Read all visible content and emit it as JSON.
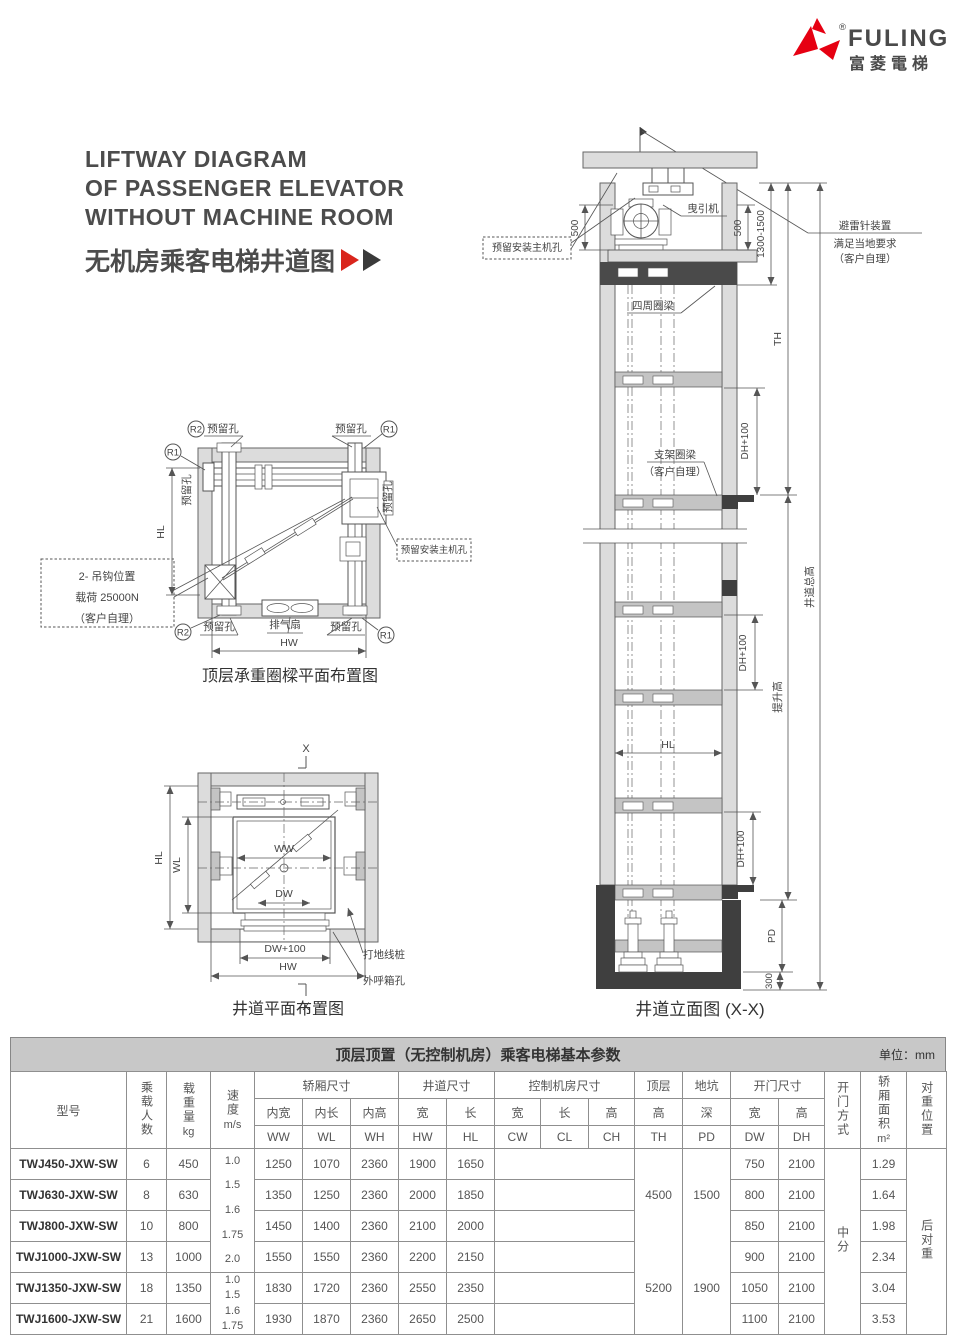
{
  "colors": {
    "brand_red": "#e60012",
    "arrow_red": "#d9251c",
    "ink": "#4c4c4c"
  },
  "logo": {
    "brand": "FULING",
    "brand_cn": "富菱電梯",
    "registered": "®"
  },
  "title": {
    "line1": "LIFTWAY DIAGRAM",
    "line2": "OF PASSENGER ELEVATOR",
    "line3": "WITHOUT MACHINE ROOM",
    "subtitle_cn": "无机房乘客电梯井道图"
  },
  "plan_top": {
    "caption": "顶层承重圈樑平面布置图",
    "r1": "R1",
    "r2": "R2",
    "hole": "预留孔",
    "hl": "HL",
    "hw": "HW",
    "fan": "排气扇",
    "hook1": "2- 吊钩位置",
    "hook2": "载荷 25000N",
    "hook3": "（客户自理）",
    "machine_hole": "预留安装主机孔"
  },
  "plan_bottom": {
    "caption": "井道平面布置图",
    "x": "X",
    "hl": "HL",
    "wl": "WL",
    "ww": "WW",
    "dw": "DW",
    "dw100": "DW+100",
    "hw": "HW",
    "stake": "打地线桩",
    "callbox": "外呼箱孔"
  },
  "elevation": {
    "caption": "井道立面图 (X-X)",
    "traction": "曳引机",
    "machine_hole": "预留安装主机孔",
    "d500": "500",
    "d1300": "1300-1500",
    "lightning1": "避雷针装置",
    "lightning2": "满足当地要求",
    "lightning3": "（客户自理）",
    "ring": "四周圈梁",
    "support1": "支架圈梁",
    "support2": "（客户自理）",
    "th": "TH",
    "total": "井道总高",
    "lift": "提升高",
    "dh100": "DH+100",
    "hl": "HL",
    "pd": "PD",
    "d300": "300"
  },
  "table": {
    "title": "顶层顶置（无控制机房）乘客电梯基本参数",
    "unit": "单位：mm",
    "h": {
      "model": "型号",
      "persons": "乘载人数",
      "load": "载重量",
      "load_unit": "kg",
      "speed": "速度",
      "speed_unit": "m/s",
      "car": "轿厢尺寸",
      "shaft": "井道尺寸",
      "ctrl": "控制机房尺寸",
      "top": "顶层",
      "pit": "地坑",
      "door": "开门尺寸",
      "iw": "内宽",
      "il": "内长",
      "ih": "内高",
      "w": "宽",
      "l": "长",
      "h2": "高",
      "deep": "深",
      "ww": "WW",
      "wl": "WL",
      "wh": "WH",
      "hw": "HW",
      "hl": "HL",
      "cw": "CW",
      "cl": "CL",
      "ch": "CH",
      "th": "TH",
      "pd": "PD",
      "dw": "DW",
      "dh": "DH",
      "door_mode": "开门方式",
      "area": "轿厢面积",
      "area_unit": "m²",
      "cwp": "对重位置"
    },
    "speed_g1": [
      "1.0",
      "1.5",
      "1.6",
      "1.75",
      "2.0"
    ],
    "speed_g2": [
      "1.0",
      "1.5",
      "1.6",
      "1.75"
    ],
    "th_vals": [
      "4500",
      "5200"
    ],
    "pd_vals": [
      "1500",
      "1900"
    ],
    "door_mode_val": "中分",
    "cwp_val": "后对重",
    "rows": [
      {
        "model": "TWJ450-JXW-SW",
        "p": "6",
        "load": "450",
        "ww": "1250",
        "wl": "1070",
        "wh": "2360",
        "hw": "1900",
        "hl": "1650",
        "dw": "750",
        "dh": "2100",
        "area": "1.29"
      },
      {
        "model": "TWJ630-JXW-SW",
        "p": "8",
        "load": "630",
        "ww": "1350",
        "wl": "1250",
        "wh": "2360",
        "hw": "2000",
        "hl": "1850",
        "dw": "800",
        "dh": "2100",
        "area": "1.64"
      },
      {
        "model": "TWJ800-JXW-SW",
        "p": "10",
        "load": "800",
        "ww": "1450",
        "wl": "1400",
        "wh": "2360",
        "hw": "2100",
        "hl": "2000",
        "dw": "850",
        "dh": "2100",
        "area": "1.98"
      },
      {
        "model": "TWJ1000-JXW-SW",
        "p": "13",
        "load": "1000",
        "ww": "1550",
        "wl": "1550",
        "wh": "2360",
        "hw": "2200",
        "hl": "2150",
        "dw": "900",
        "dh": "2100",
        "area": "2.34"
      },
      {
        "model": "TWJ1350-JXW-SW",
        "p": "18",
        "load": "1350",
        "ww": "1830",
        "wl": "1720",
        "wh": "2360",
        "hw": "2550",
        "hl": "2350",
        "dw": "1050",
        "dh": "2100",
        "area": "3.04"
      },
      {
        "model": "TWJ1600-JXW-SW",
        "p": "21",
        "load": "1600",
        "ww": "1930",
        "wl": "1870",
        "wh": "2360",
        "hw": "2650",
        "hl": "2500",
        "dw": "1100",
        "dh": "2100",
        "area": "3.53"
      }
    ]
  }
}
